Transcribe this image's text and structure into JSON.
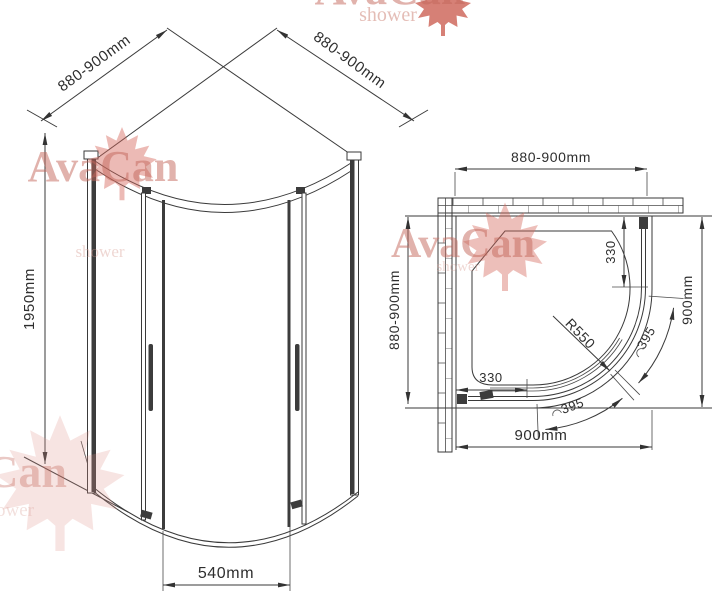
{
  "front_view": {
    "dim_left_wall": "880-900mm",
    "dim_right_wall": "880-900mm",
    "dim_height": "1950mm",
    "dim_door": "540mm"
  },
  "plan_view": {
    "dim_top": "880-900mm",
    "dim_left": "880-900mm",
    "dim_right": "900mm",
    "dim_bottom": "900mm",
    "dim_straight_right": "330",
    "dim_straight_bottom": "330",
    "dim_radius": "R550",
    "dim_arc_right": "395",
    "dim_arc_bottom": "395"
  },
  "watermark": {
    "brand": "AvaCan",
    "subtitle": "shower",
    "leaf_color": "#c85548",
    "text_color": "#c4685c"
  }
}
